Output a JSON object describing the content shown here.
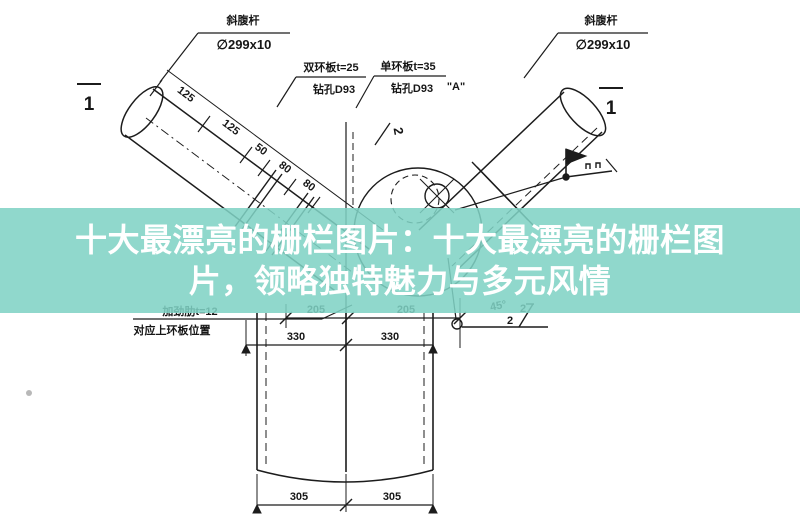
{
  "page": {
    "background": "#ffffff"
  },
  "banner": {
    "title_line1": "十大最漂亮的栅栏图片：十大最漂亮的栅栏图",
    "title_line2": "片，领略独特魅力与多元风情",
    "background_color": "rgba(127,210,196,0.87)",
    "text_color": "#ffffff"
  },
  "drawing": {
    "member_labels": {
      "left_name": "斜腹杆",
      "left_size": "∅299x10",
      "right_name": "斜腹杆",
      "right_size": "∅299x10"
    },
    "plate_labels": {
      "double_ring": "双环板t=25",
      "double_ring_hole": "钻孔D93",
      "single_ring": "单环板t=35",
      "single_ring_hole": "钻孔D93",
      "detail_mark": "\"A\""
    },
    "stiffener": {
      "line1": "加劲肋t=12",
      "line2": "对应上环板位置"
    },
    "section_marks": {
      "left": "1",
      "right": "1"
    },
    "slope_mark": "2",
    "weld_detail": {
      "angle": "45°",
      "gap": "2",
      "root": "2"
    },
    "dimensions": {
      "diag": [
        "125",
        "125",
        "50",
        "80",
        "80"
      ],
      "mid_205": [
        "205",
        "205"
      ],
      "mid_330": [
        "330",
        "330"
      ],
      "bottom_305": [
        "305",
        "305"
      ]
    }
  }
}
